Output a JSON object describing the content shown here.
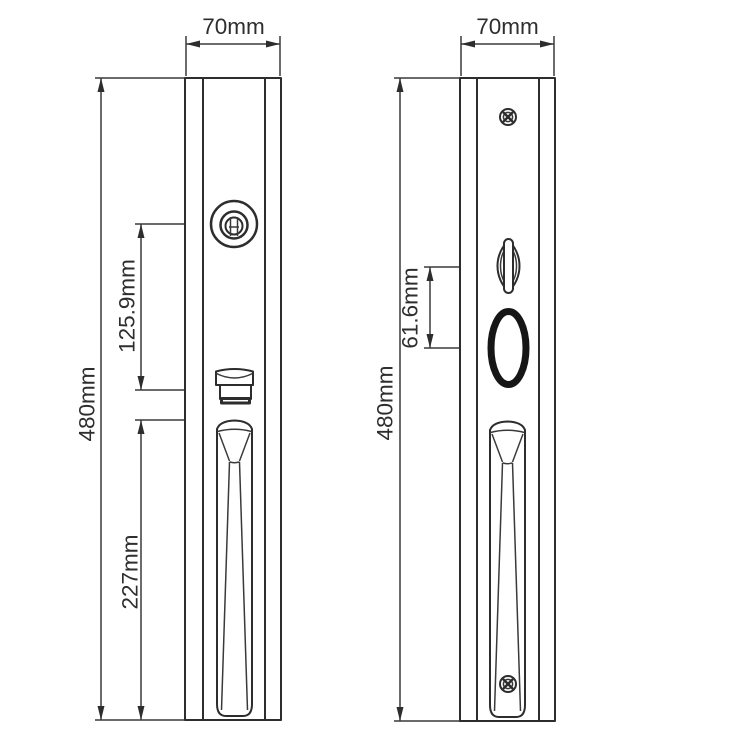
{
  "colors": {
    "background": "#ffffff",
    "line": "#2d2d2d",
    "dimension_text": "#2e2e2e",
    "hole_ring": "#161616"
  },
  "left_view": {
    "width_label": "70mm",
    "height_label": "480mm",
    "cylinder_to_latch_label": "125.9mm",
    "handle_length_label": "227mm"
  },
  "right_view": {
    "width_label": "70mm",
    "height_label": "480mm",
    "thumbturn_to_hole_label": "61.6mm"
  }
}
